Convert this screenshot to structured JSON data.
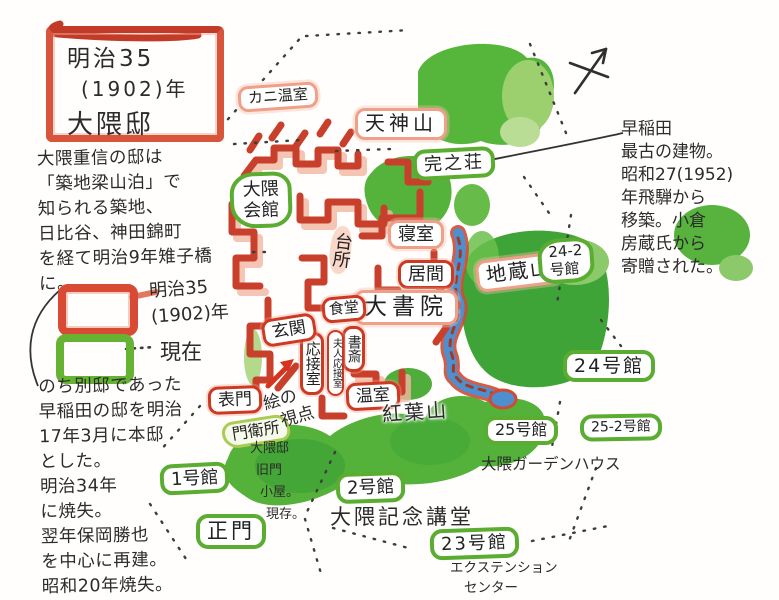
{
  "colors": {
    "era1902_red": "#cd3a24",
    "era1902_salmon": "#efa088",
    "current_green": "#5aad30",
    "foliage_green": "#54b13a",
    "river_blue": "#4e8fd0",
    "ink": "#2b2b2b"
  },
  "title": {
    "lines": [
      "明治35",
      "(1902)年",
      "大隈邸"
    ]
  },
  "intro": {
    "lines": [
      "大隈重信の邸は",
      "「築地梁山泊」で",
      "知られる築地、",
      "日比谷、神田錦町",
      "を経て明治9年雉子橋",
      "に。"
    ]
  },
  "legend": {
    "meiji": {
      "lines": [
        "明治35",
        "(1902)年"
      ]
    },
    "current": {
      "label": "現在",
      "dots": "・・・・"
    }
  },
  "history_note": {
    "lines": [
      "のち別邸であった",
      "早稲田の邸を明治",
      "17年3月に本邸",
      "とした。",
      "明治34年",
      "に焼失。",
      "翌年保岡勝也",
      "を中心に再建。",
      "昭和20年焼失。"
    ]
  },
  "kanshiso_note": {
    "lines": [
      "早稲田",
      "最古の建物。",
      "昭和27(1952)",
      "年飛騨から",
      "移築。小倉",
      "房蔵氏から",
      "寄贈された。"
    ]
  },
  "map": {
    "era1902": {
      "kani_onshitsu": "カニ温室",
      "tenjinyama": "天神山",
      "daidokoro": "台所",
      "shinshitsu": "寝室",
      "ima": "居間",
      "daishoin": "大書院",
      "shokudo": "食堂",
      "shosai": "書斎",
      "fujin_osetsushitsu": "夫人応接室",
      "osetsushitsu": "応接室",
      "genkan": "玄関",
      "onshitsu": "温室",
      "omotemon": "表門",
      "koyozan": "紅葉山",
      "jizozan": "地蔵山"
    },
    "current": {
      "okuma_kaikan": {
        "lines": [
          "大隈",
          "会館"
        ]
      },
      "kanshiso": "完之荘",
      "bldg_24_2": {
        "lines": [
          "24-2",
          "号館"
        ]
      },
      "bldg_24": "24号館",
      "bldg_25": "25号館",
      "okuma_garden_house": "大隈ガーデンハウス",
      "bldg_25_2": "25-2号館",
      "bldg_2": "2号館",
      "okuma_auditorium": "大隈記念講堂",
      "bldg_23": "23号館",
      "extension_center": {
        "lines": [
          "エクステンション",
          "センター"
        ]
      },
      "bldg_1": "1号館",
      "seimon": "正門",
      "monei_sho": "門衛所"
    },
    "notes": {
      "old_gate": {
        "lines": [
          "大隈邸",
          "旧門",
          "小屋。",
          "現存。"
        ]
      },
      "viewpoint": {
        "lines": [
          "絵の",
          "視点"
        ]
      }
    }
  }
}
